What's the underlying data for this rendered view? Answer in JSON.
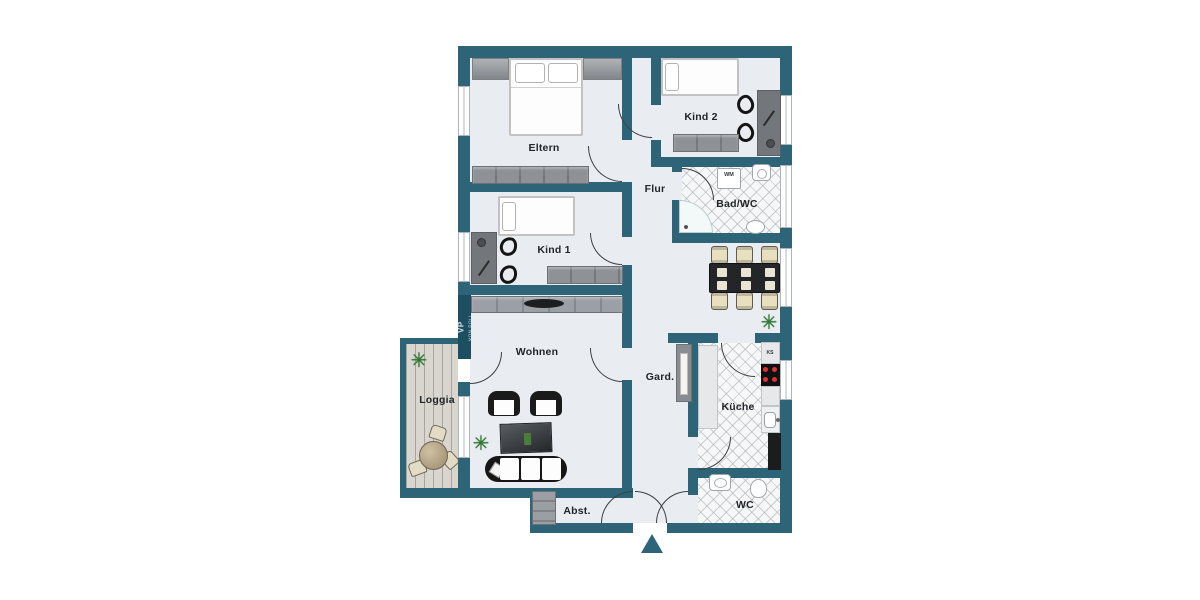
{
  "plan": {
    "type": "apartment-floor-plan",
    "language": "de"
  },
  "rooms": {
    "eltern": {
      "label": "Eltern"
    },
    "kind2": {
      "label": "Kind 2"
    },
    "kind1": {
      "label": "Kind 1"
    },
    "flur": {
      "label": "Flur"
    },
    "bad": {
      "label": "Bad/WC"
    },
    "wohnen": {
      "label": "Wohnen"
    },
    "loggia": {
      "label": "Loggia"
    },
    "gard": {
      "label": "Gard."
    },
    "kueche": {
      "label": "Küche"
    },
    "wc": {
      "label": "WC"
    },
    "abst": {
      "label": "Abst."
    }
  },
  "appliances": {
    "wm": "WM",
    "ks": "KS"
  },
  "watermark": {
    "initials": "VP",
    "name": "VON POLL"
  },
  "icons": {
    "plant": "✳"
  },
  "colors": {
    "wall": "#2e6477",
    "floor": "#e9edf2",
    "tile": "#f6f7f7",
    "deck": "#d9d6d0",
    "burner_red": "#dd3333",
    "plant_green": "#2c7a2f"
  }
}
